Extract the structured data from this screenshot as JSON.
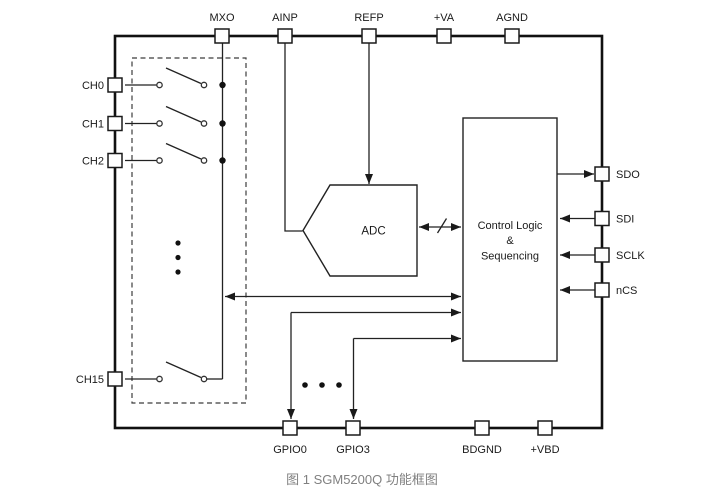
{
  "figure": {
    "caption": "图 1 SGM5200Q 功能框图"
  },
  "blocks": {
    "adc_label": "ADC",
    "control_logic_line1": "Control Logic",
    "control_logic_line2": "&",
    "control_logic_line3": "Sequencing"
  },
  "pins": {
    "top": [
      {
        "label": "MXO"
      },
      {
        "label": "AINP"
      },
      {
        "label": "REFP"
      },
      {
        "label": "+VA"
      },
      {
        "label": "AGND"
      }
    ],
    "left": [
      {
        "label": "CH0"
      },
      {
        "label": "CH1"
      },
      {
        "label": "CH2"
      },
      {
        "label": "CH15"
      }
    ],
    "right": [
      {
        "label": "SDO"
      },
      {
        "label": "SDI"
      },
      {
        "label": "SCLK"
      },
      {
        "label": "nCS"
      }
    ],
    "bottom": [
      {
        "label": "GPIO0"
      },
      {
        "label": "GPIO3"
      },
      {
        "label": "BDGND"
      },
      {
        "label": "+VBD"
      }
    ]
  },
  "colors": {
    "line": "#1a1a1a",
    "background": "#ffffff",
    "caption_text": "#808080",
    "block_fill": "#ffffff"
  }
}
